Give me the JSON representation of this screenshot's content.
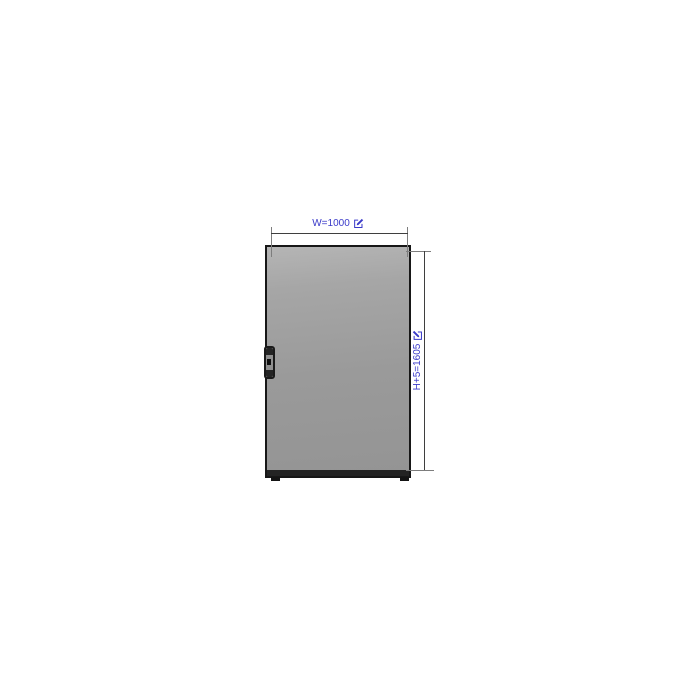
{
  "colors": {
    "background": "#ffffff",
    "accent": "#3a3ac9",
    "panel-fill": "#9a9a9a",
    "panel-fill-light": "#b5b5b5",
    "panel-border": "#171717",
    "plinth": "#232323",
    "dim-line": "#3f3f3f",
    "ext-line": "#7d7d7d"
  },
  "drawing": {
    "panel": {
      "kind": "door-panel-front-view"
    },
    "dimensions": {
      "width": {
        "label": "W=1000",
        "value": 1000,
        "icon": "edit-icon",
        "orientation": "horizontal"
      },
      "height": {
        "label": "H+5=1605",
        "value": 1605,
        "icon": "edit-icon",
        "orientation": "vertical"
      }
    }
  }
}
